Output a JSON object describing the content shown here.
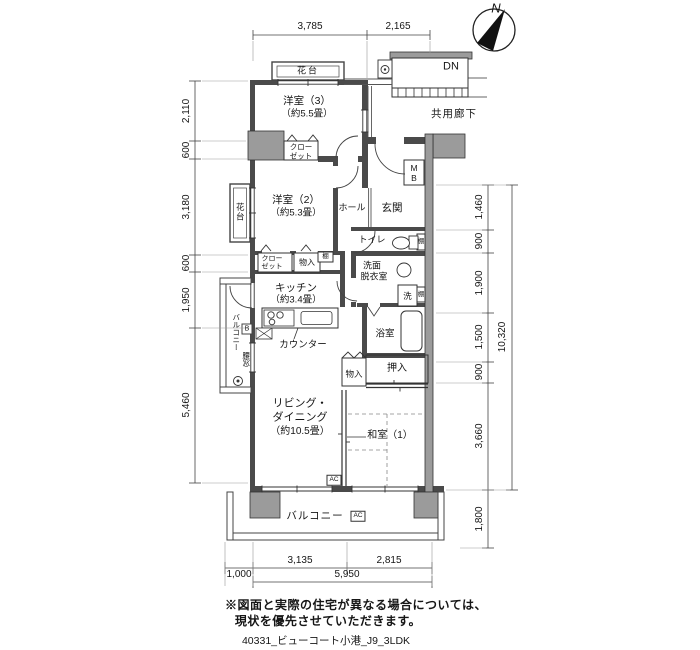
{
  "compass": {
    "north": "N"
  },
  "common": {
    "dn": "DN",
    "corridor": "共用廊下"
  },
  "rooms": {
    "western3": "洋室（3）",
    "western3_size": "（約5.5畳）",
    "western2": "洋室（2）",
    "western2_size": "（約5.3畳）",
    "kitchen": "キッチン",
    "kitchen_size": "（約3.4畳）",
    "living1": "リビング・",
    "living2": "ダイニング",
    "living_size": "（約10.5畳）",
    "japanese": "和室（1）",
    "hall": "ホール",
    "entrance": "玄関",
    "toilet": "トイレ",
    "washroom1": "洗面",
    "washroom2": "脱衣室",
    "bath": "浴室",
    "oshiire": "押入",
    "storage": "物入",
    "closet_l1": "クロー",
    "closet_l2": "ゼット",
    "balcony": "バルコニー",
    "hanadai": "花台",
    "koshimado": "腰窓",
    "counter": "カウンター",
    "mb_m": "M",
    "mb_b": "B",
    "shelf": "棚",
    "wash": "洗",
    "ac": "AC",
    "hatch_b": "B"
  },
  "dims": {
    "top": [
      "3,785",
      "2,165"
    ],
    "left": [
      "2,110",
      "600",
      "3,180",
      "600",
      "1,950",
      "5,460"
    ],
    "right": [
      "1,460",
      "900",
      "1,900",
      "1,500",
      "900",
      "3,660",
      "1,800"
    ],
    "right_total": "10,320",
    "bottom": [
      "1,000",
      "3,135",
      "2,815"
    ],
    "bottom_total": "5,950"
  },
  "notes": {
    "line1": "※図面と実際の住宅が異なる場合については、",
    "line2": "現状を優先させていただきます。",
    "caption": "40331_ビューコート小港_J9_3LDK"
  },
  "colors": {
    "wall": "#4a4a4a",
    "block": "#9b9b9b",
    "line": "#333333"
  }
}
